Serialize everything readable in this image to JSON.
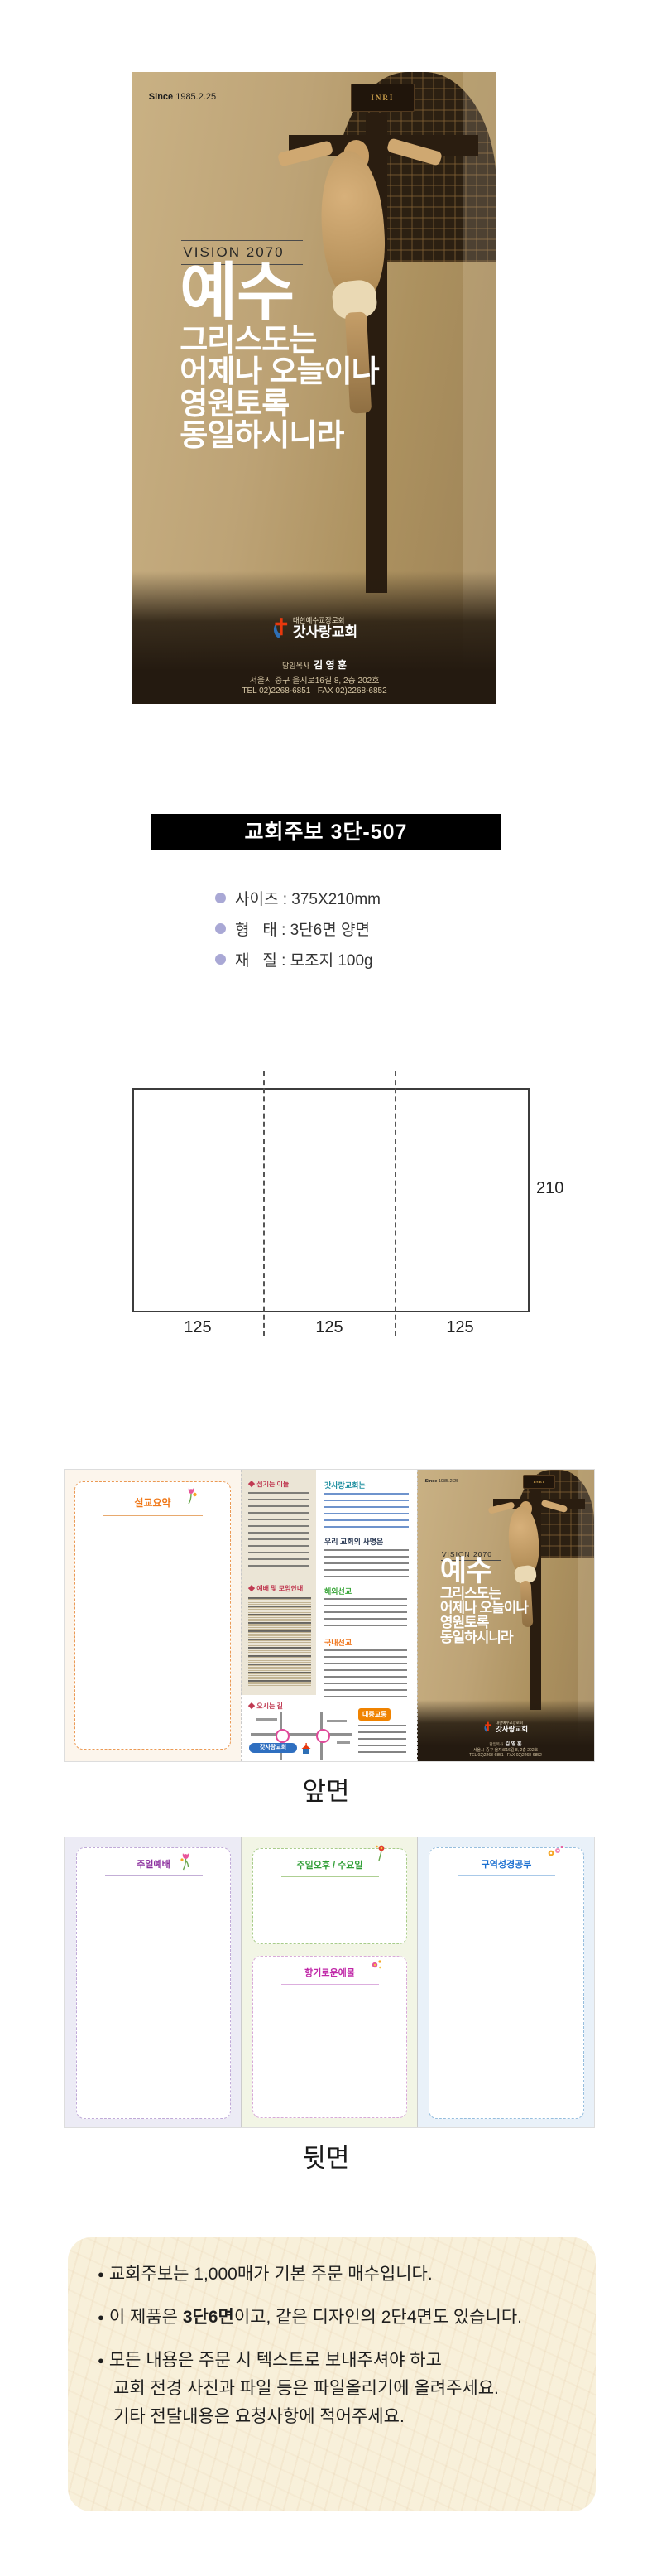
{
  "cover": {
    "since_label": "Since ",
    "since_date": "1985.2.25",
    "inri": "INRI",
    "vision": "VISION 2070",
    "headline": [
      "예수",
      "그리스도는",
      "어제나 오늘이나",
      "영원토록",
      "동일하시니라"
    ],
    "denomination": "대한예수교장로회",
    "church_name": "갓사랑교회",
    "pastor_label": "담임목사  ",
    "pastor_name": "김 영 훈",
    "address": "서울시 중구 을지로16길 8, 2층 202호",
    "contact": "TEL 02)2268-6851   FAX 02)2268-6852"
  },
  "product": {
    "title": "교회주보 3단-507",
    "specs": [
      "사이즈 : 375X210mm",
      "형   태 : 3단6면 양면",
      "재   질 : 모조지 100g"
    ]
  },
  "diagram": {
    "height_label": "210",
    "width_labels": [
      "125",
      "125",
      "125"
    ]
  },
  "front_preview": {
    "caption": "앞면",
    "sermon_header": "설교요약",
    "serving_header": "◆ 섬기는 이들",
    "worship_header": "◆ 예배 및 모임안내",
    "about_header": "갓사랑교회는",
    "mission_header": "우리 교회의 사명은",
    "overseas_header": "해외선교",
    "domestic_header": "국내선교",
    "directions_header": "◆ 오시는 길",
    "church_tag": "갓사랑교회",
    "transit_badge": "대중교통"
  },
  "back_preview": {
    "caption": "뒷면",
    "panel1_header": "주일예배",
    "panel2_top_header": "주일오후 / 수요일",
    "panel2_bottom_header": "향기로운예물",
    "panel3_header": "구역성경공부"
  },
  "notes": {
    "bullet": "●",
    "item1": "교회주보는 1,000매가 기본 주문 매수입니다.",
    "item2_pre": "이 제품은 ",
    "item2_bold": "3단6면",
    "item2_post": "이고, 같은 디자인의 2단4면도 있습니다.",
    "item3_line1": "모든 내용은 주문 시 텍스트로 보내주셔야 하고",
    "item3_line2": "교회 전경 사진과 파일 등은 파일올리기에 올려주세요.",
    "item3_line3": "기타 전달내용은 요청사항에 적어주세요."
  },
  "colors": {
    "cover_tan": "#bda376",
    "cover_dark": "#241a10",
    "title_bar_bg": "#000000",
    "spec_bullet": "#a9a8d5",
    "note_bg": "#f8f0da",
    "logo_red": "#e8380d",
    "logo_blue": "#2e6fb5"
  }
}
